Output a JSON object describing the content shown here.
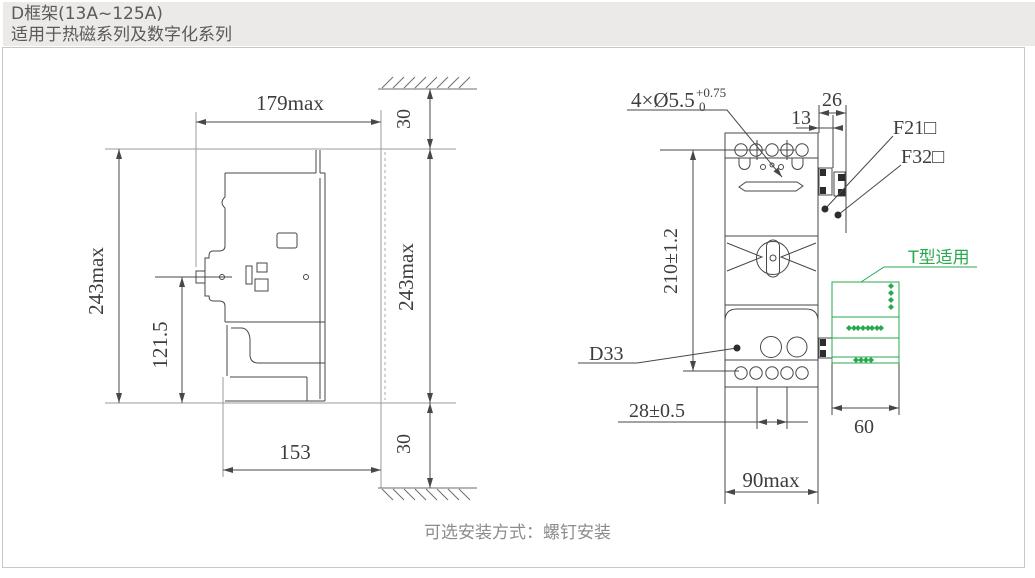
{
  "header": {
    "title_line1": "D框架(13A~125A)",
    "title_line2": "适用于热磁系列及数字化系列"
  },
  "footer": {
    "caption": "可选安装方式：螺钉安装"
  },
  "colors": {
    "accent_green": "#29a94f",
    "line": "#474747",
    "reference_line": "#9b9b9b",
    "header_bg": "#eceae8",
    "header_text": "#5a5a5a",
    "caption_text": "#8c8c8c",
    "panel_border": "#cbc7c2"
  },
  "side_view": {
    "dims": {
      "width": "179max",
      "height": "243max",
      "handle_center_height": "121.5",
      "depth": "153",
      "top_clearance": "30",
      "bottom_clearance": "30",
      "height_right": "243max"
    }
  },
  "front_view": {
    "labels": {
      "mounting_holes": "4×Ø5.5",
      "hole_tol_upper": "+0.75",
      "hole_tol_lower": "0",
      "f21": "F21□",
      "f32": "F32□",
      "d33": "D33",
      "t_type": "T型适用"
    },
    "dims": {
      "offset": "13",
      "accessory_width": "26",
      "hole_span_v": "210±1.2",
      "pole_pitch": "28±0.5",
      "width": "90max",
      "t_depth": "60"
    }
  }
}
